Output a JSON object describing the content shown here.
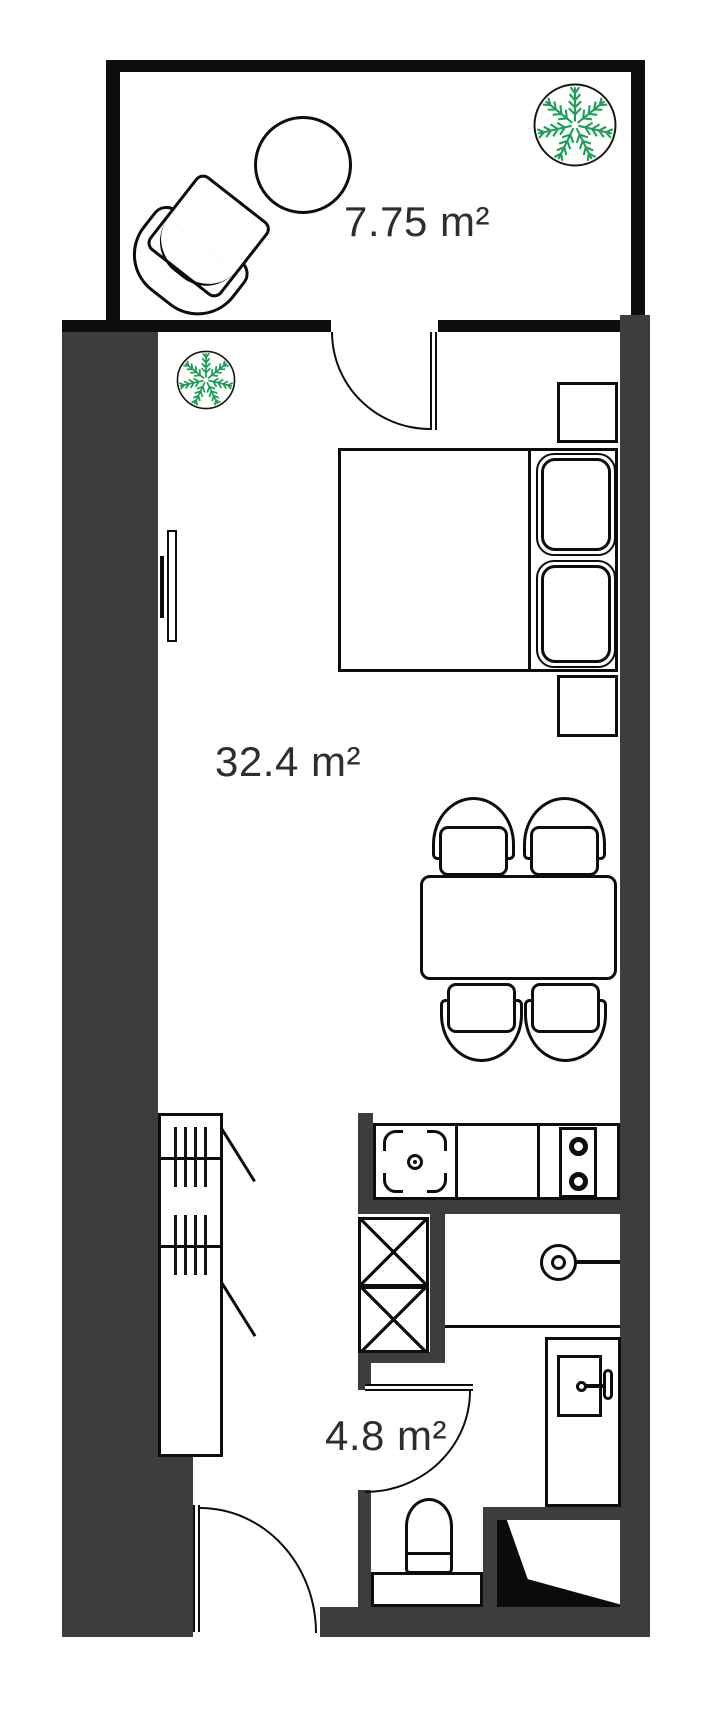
{
  "rooms": [
    {
      "name": "balcony",
      "area_label": "7.75 m²"
    },
    {
      "name": "living-room",
      "area_label": "32.4 m²"
    },
    {
      "name": "bathroom",
      "area_label": "4.8 m²"
    }
  ],
  "colors": {
    "wall_thick": "#3d3d3d",
    "wall_thin": "#0d0d0d",
    "background": "#ffffff",
    "plant_green": "#1e9e57",
    "label_text": "#2e2e2e"
  },
  "furniture_icons": [
    "armchair",
    "round-table",
    "potted-plant",
    "potted-plant",
    "tv",
    "double-bed",
    "pillow",
    "pillow",
    "nightstand",
    "nightstand",
    "dining-table",
    "chair",
    "chair",
    "chair",
    "chair",
    "wardrobe",
    "kitchen-counter",
    "kitchen-sink",
    "stove-2-burners",
    "ventilation-shaft",
    "ventilation-shaft",
    "washbasin",
    "utility-cabinet",
    "toilet",
    "shower"
  ]
}
